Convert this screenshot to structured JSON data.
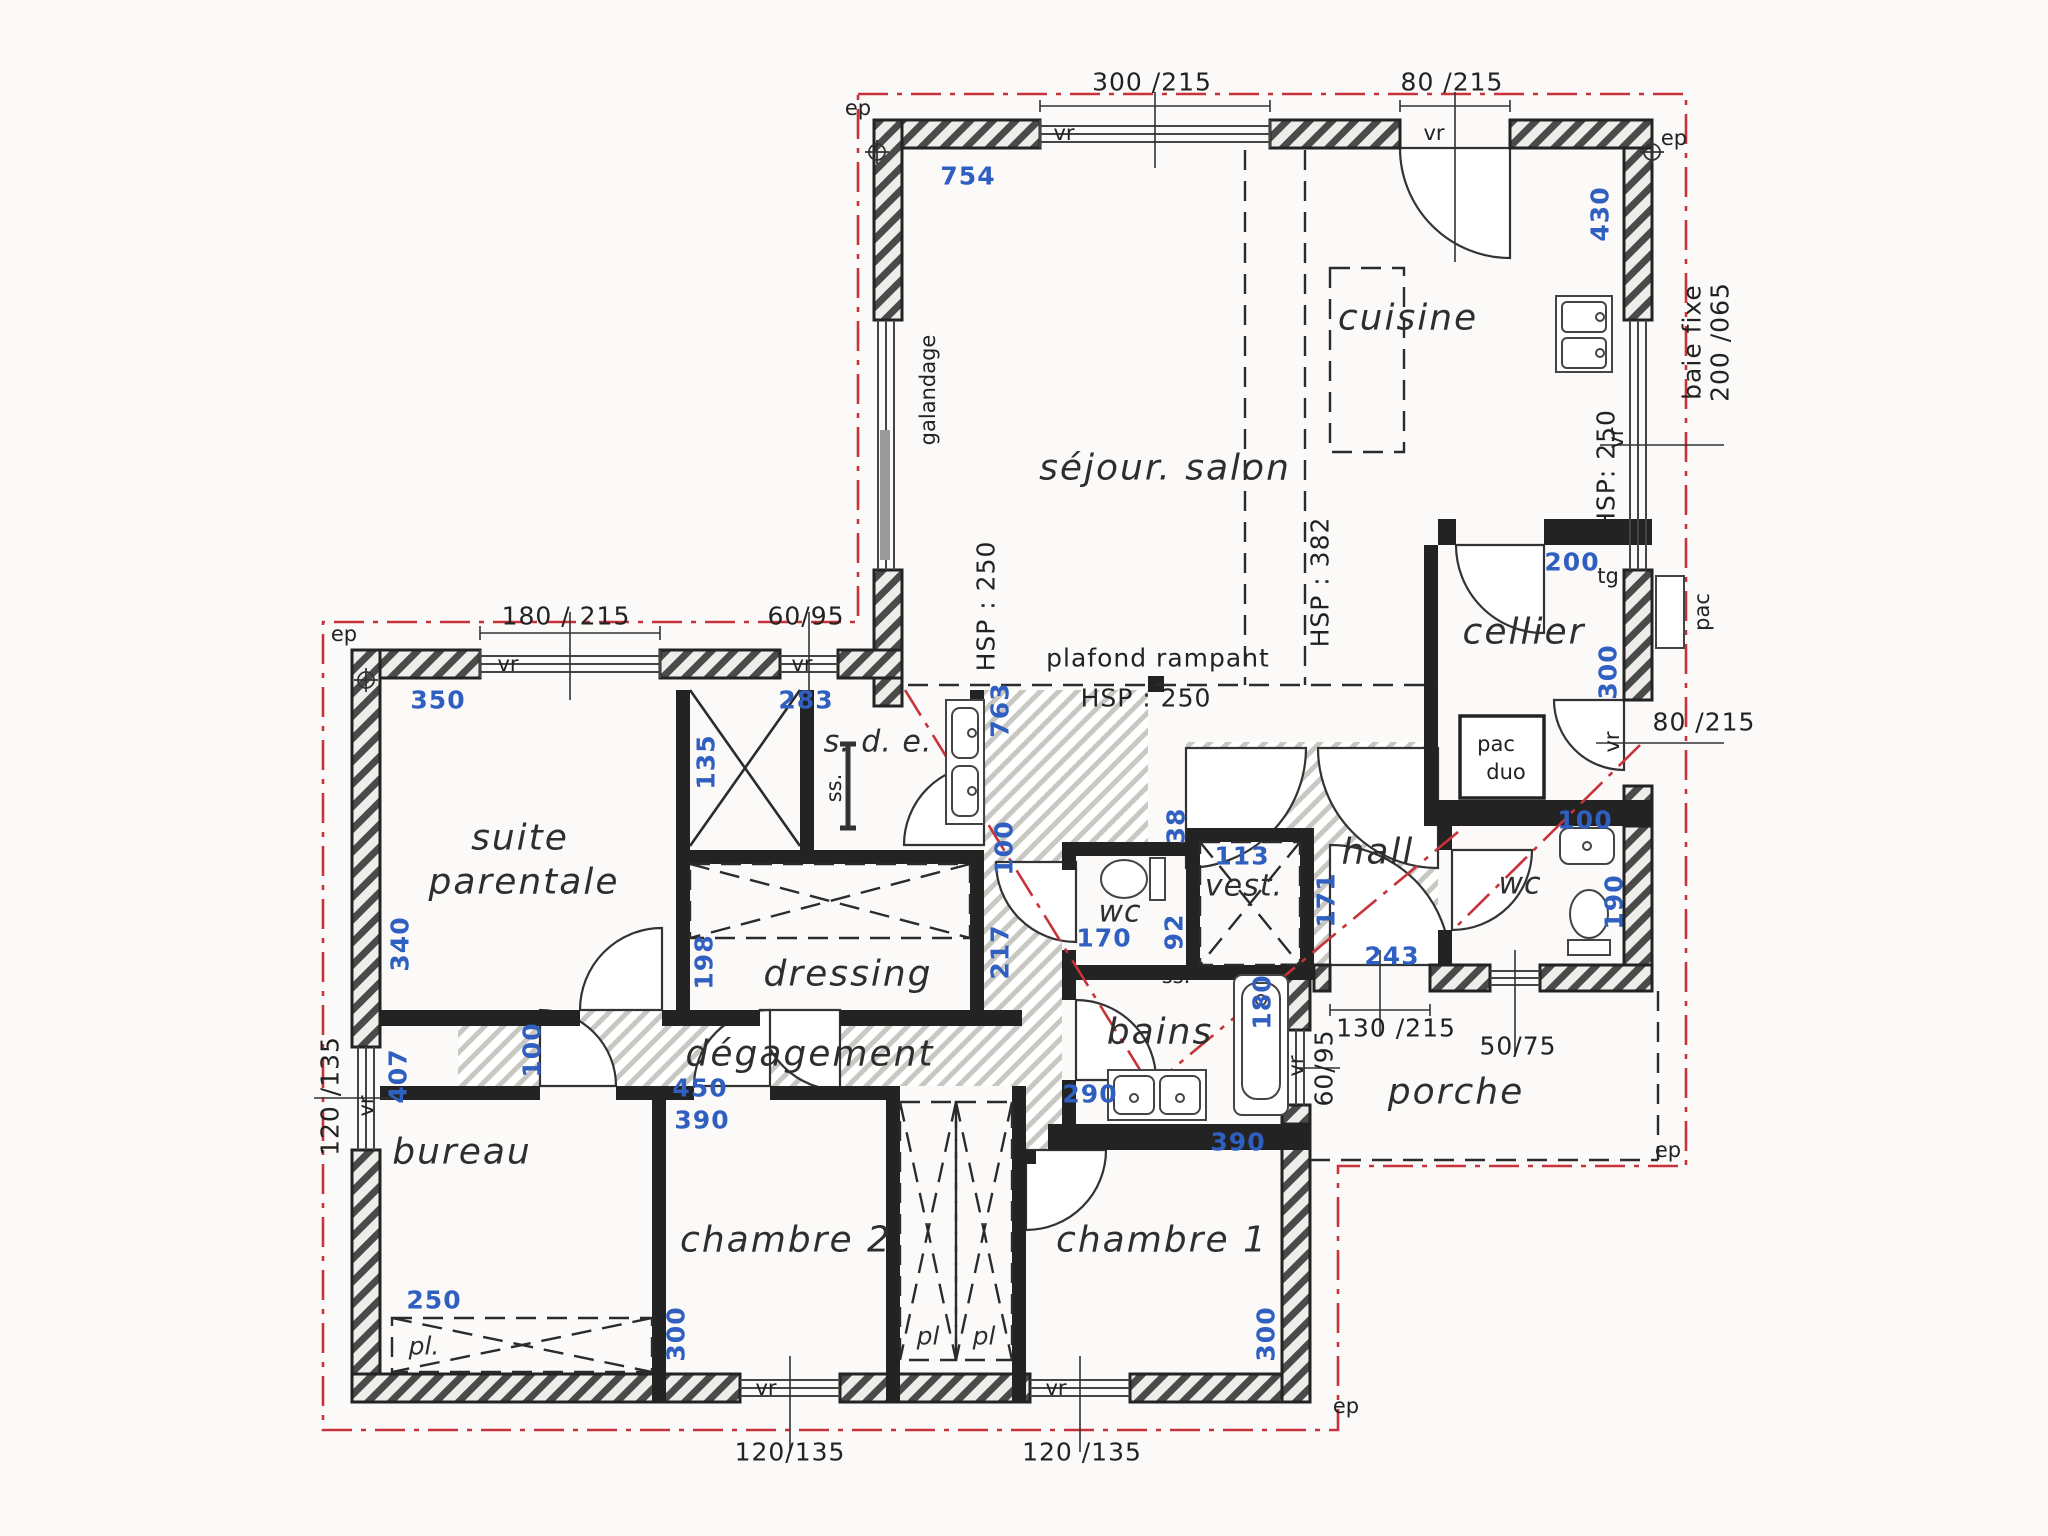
{
  "plan_type": "floor-plan",
  "colors": {
    "wall": "#232323",
    "dim_blue": "#2f5fc0",
    "roof_red": "#c8323a",
    "paper": "#fbfaf8"
  },
  "rooms": {
    "sejour": "séjour. salon",
    "cuisine": "cuisine",
    "cellier": "cellier",
    "hall": "hall",
    "wc_right": "wc",
    "wc_center": "wc",
    "vest": "vest.",
    "sde": "s. d. e.",
    "dressing": "dressing",
    "degagement": "dégagement",
    "suite_l1": "suite",
    "suite_l2": "parentale",
    "bureau": "bureau",
    "chambre2": "chambre 2",
    "chambre1": "chambre 1",
    "bains": "bains",
    "porche": "porche",
    "pl_bureau": "pl.",
    "pl_left": "pl",
    "pl_right": "pl",
    "pac_duo_l1": "pac",
    "pac_duo_l2": "duo"
  },
  "dims_blue": {
    "d754": "754",
    "d430": "430",
    "d200_cellier": "200",
    "d300_cellier": "300",
    "d100_wc_right": "100",
    "d190": "190",
    "d243": "243",
    "d171": "171",
    "d113": "113",
    "d38": "38",
    "d170": "170",
    "d92": "92",
    "d763": "763",
    "d100_sde": "100",
    "d217": "217",
    "d135": "135",
    "d283": "283",
    "d350": "350",
    "d340": "340",
    "d407": "407",
    "d250": "250",
    "d300_ch2": "300",
    "d300_ch1": "300",
    "d390_ch2": "390",
    "d390_ch1": "390",
    "d450": "450",
    "d100_bureau": "100",
    "d198": "198",
    "d180": "180",
    "d290": "290"
  },
  "dims_black": {
    "w300_215": "300 /215",
    "w80_215_top": "80 /215",
    "w180_215": "180 / 215",
    "w60_95": "60/95",
    "w80_215_right": "80 /215",
    "w130_215": "130 /215",
    "w50_75": "50/75",
    "w60_95_porche": "60/95",
    "w120_135_left": "120 /135",
    "w120_135_b1": "120/135",
    "w120_135_b2": "120 /135",
    "baie_fixe": "baie fixe",
    "baie_dim": "200 /065"
  },
  "annotations": {
    "hsp382": "HSP : 382",
    "hsp250_right": "HSP: 250",
    "hsp250_left": "HSP : 250",
    "plafond": "plafond rampant",
    "plafond_hsp": "HSP : 250",
    "galandage": "galandage",
    "tg": "tg",
    "pac": "pac",
    "ss_sde": "ss.",
    "ss_bains": "ss."
  },
  "markers": {
    "ep": "ep",
    "vr": "vr"
  }
}
